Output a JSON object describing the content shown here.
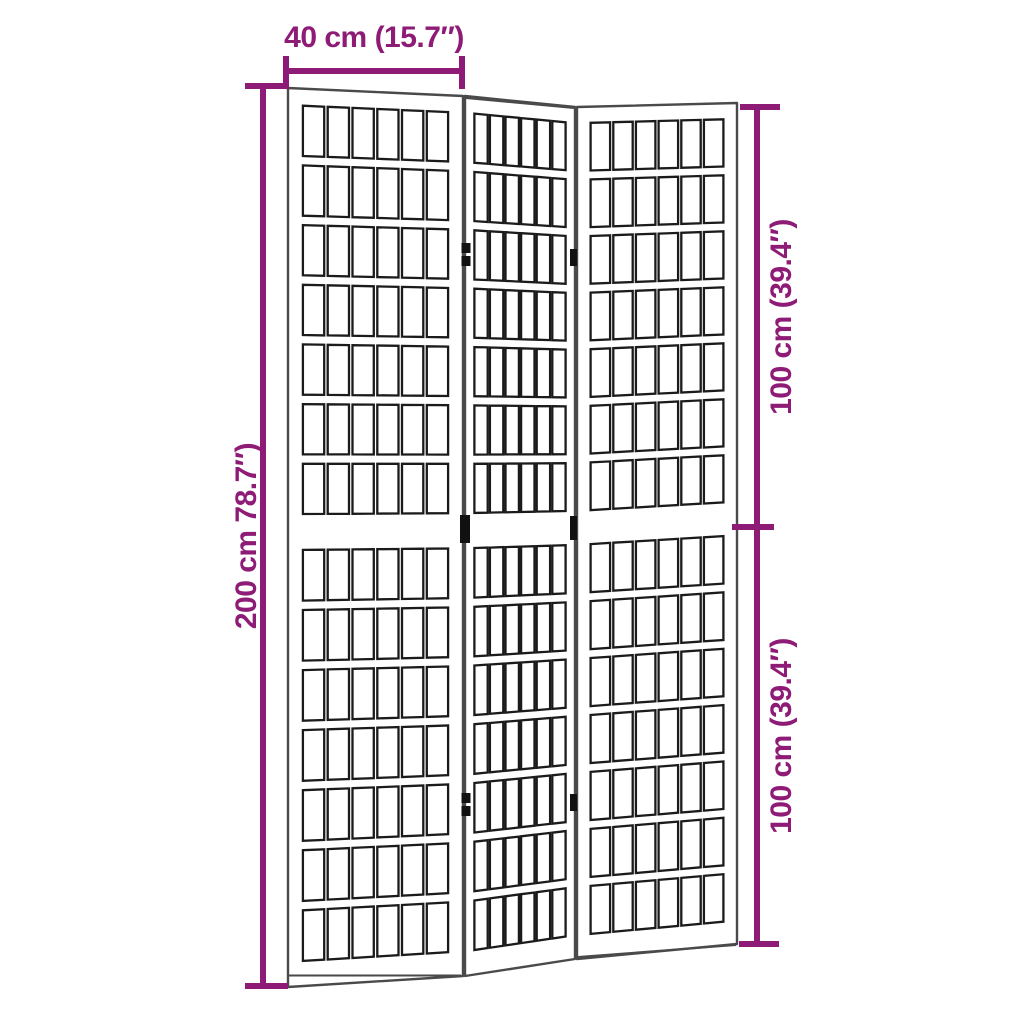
{
  "diagram": {
    "subject": "3-panel folding room divider with lattice panels"
  },
  "dimensions": {
    "width": {
      "label": "40 cm (15.7″)"
    },
    "total_height": {
      "label": "200 cm 78.7″)"
    },
    "upper_height": {
      "label": "100 cm (39.4″)"
    },
    "lower_height": {
      "label": "100 cm (39.4″)"
    }
  },
  "screen": {
    "panels": 3,
    "sections_per_panel": 2,
    "columns_per_section": 6,
    "rows_per_section": 7
  },
  "colors": {
    "dimension_accent": "#8E1B76",
    "frame_outline": "#4a4a4a",
    "lattice_outline": "#1b1b1b",
    "background": "#ffffff"
  }
}
